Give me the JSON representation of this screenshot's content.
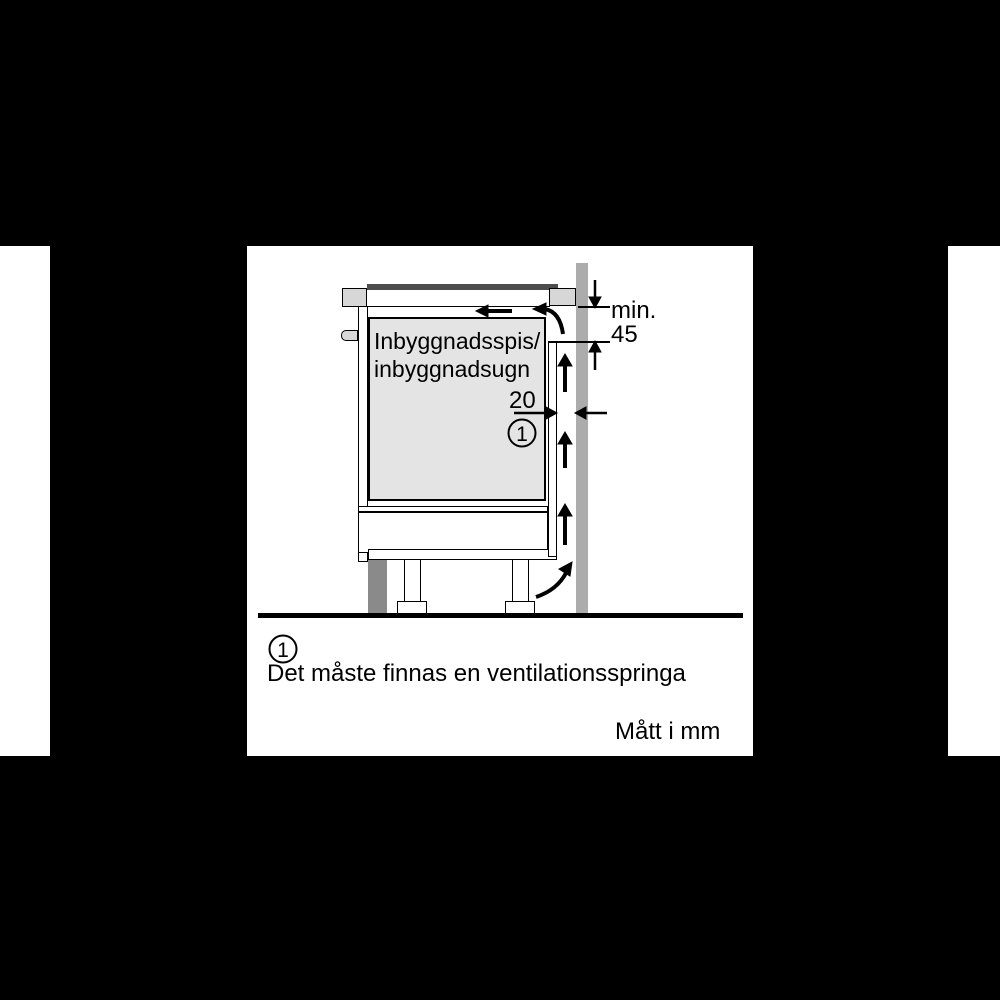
{
  "diagram": {
    "oven_label_line1": "Inbyggnadsspis/",
    "oven_label_line2": "inbyggnadsugn",
    "dim_min_label": "min.",
    "dim_min_value": "45",
    "dim_gap_value": "20",
    "callout_number": "1"
  },
  "footnote": {
    "number": "1",
    "text": "Det måste finnas en ventilationsspringa"
  },
  "units_note": "Mått i mm",
  "colors": {
    "wall": "#acacac",
    "block": "#d7d7d7",
    "oven": "#e4e4e4",
    "toe_kick": "#8a8a8a",
    "hob": "#4d4d4d",
    "line": "#000000"
  }
}
